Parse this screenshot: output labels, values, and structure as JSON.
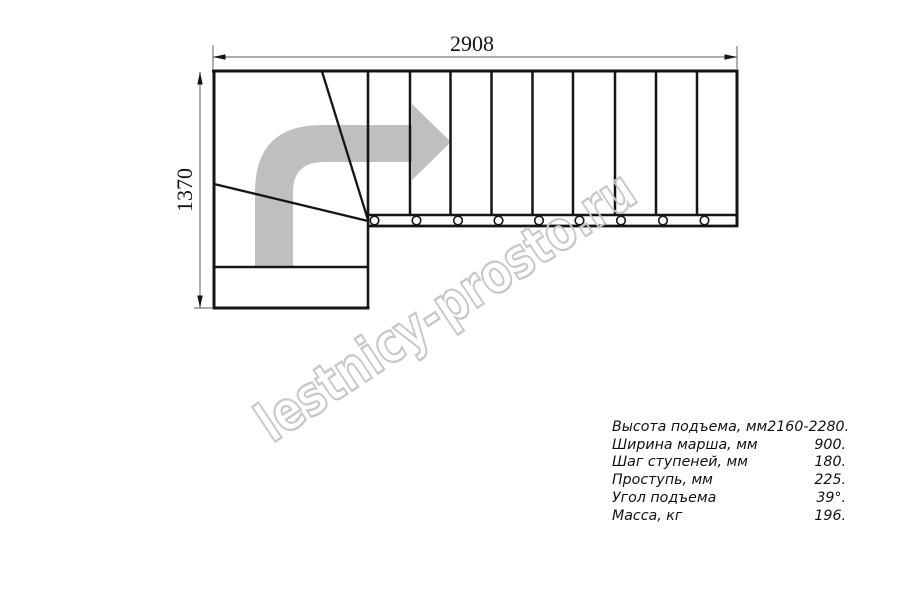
{
  "drawing": {
    "top_dimension_label": "2908",
    "left_dimension_label": "1370",
    "watermark_text": "lestnicy-prosto.ru",
    "colors": {
      "line_black": "#151515",
      "dimension_gray": "#7a7a7a",
      "arrow_fill_gray": "#bfbfbf",
      "watermark_outline_gray": "#c7c7c7",
      "background": "#ffffff"
    },
    "icons": {
      "direction_arrow": "curved-right-arrow-icon"
    }
  },
  "specs": {
    "rows": [
      {
        "label": "Высота подъема, мм",
        "value": "2160-2280."
      },
      {
        "label": "Ширина марша, мм",
        "value": "900."
      },
      {
        "label": "Шаг ступеней, мм",
        "value": "180."
      },
      {
        "label": "Проступь, мм",
        "value": "225."
      },
      {
        "label": "Угол подъема",
        "value": "39°."
      },
      {
        "label": "Масса, кг",
        "value": "196."
      }
    ]
  }
}
